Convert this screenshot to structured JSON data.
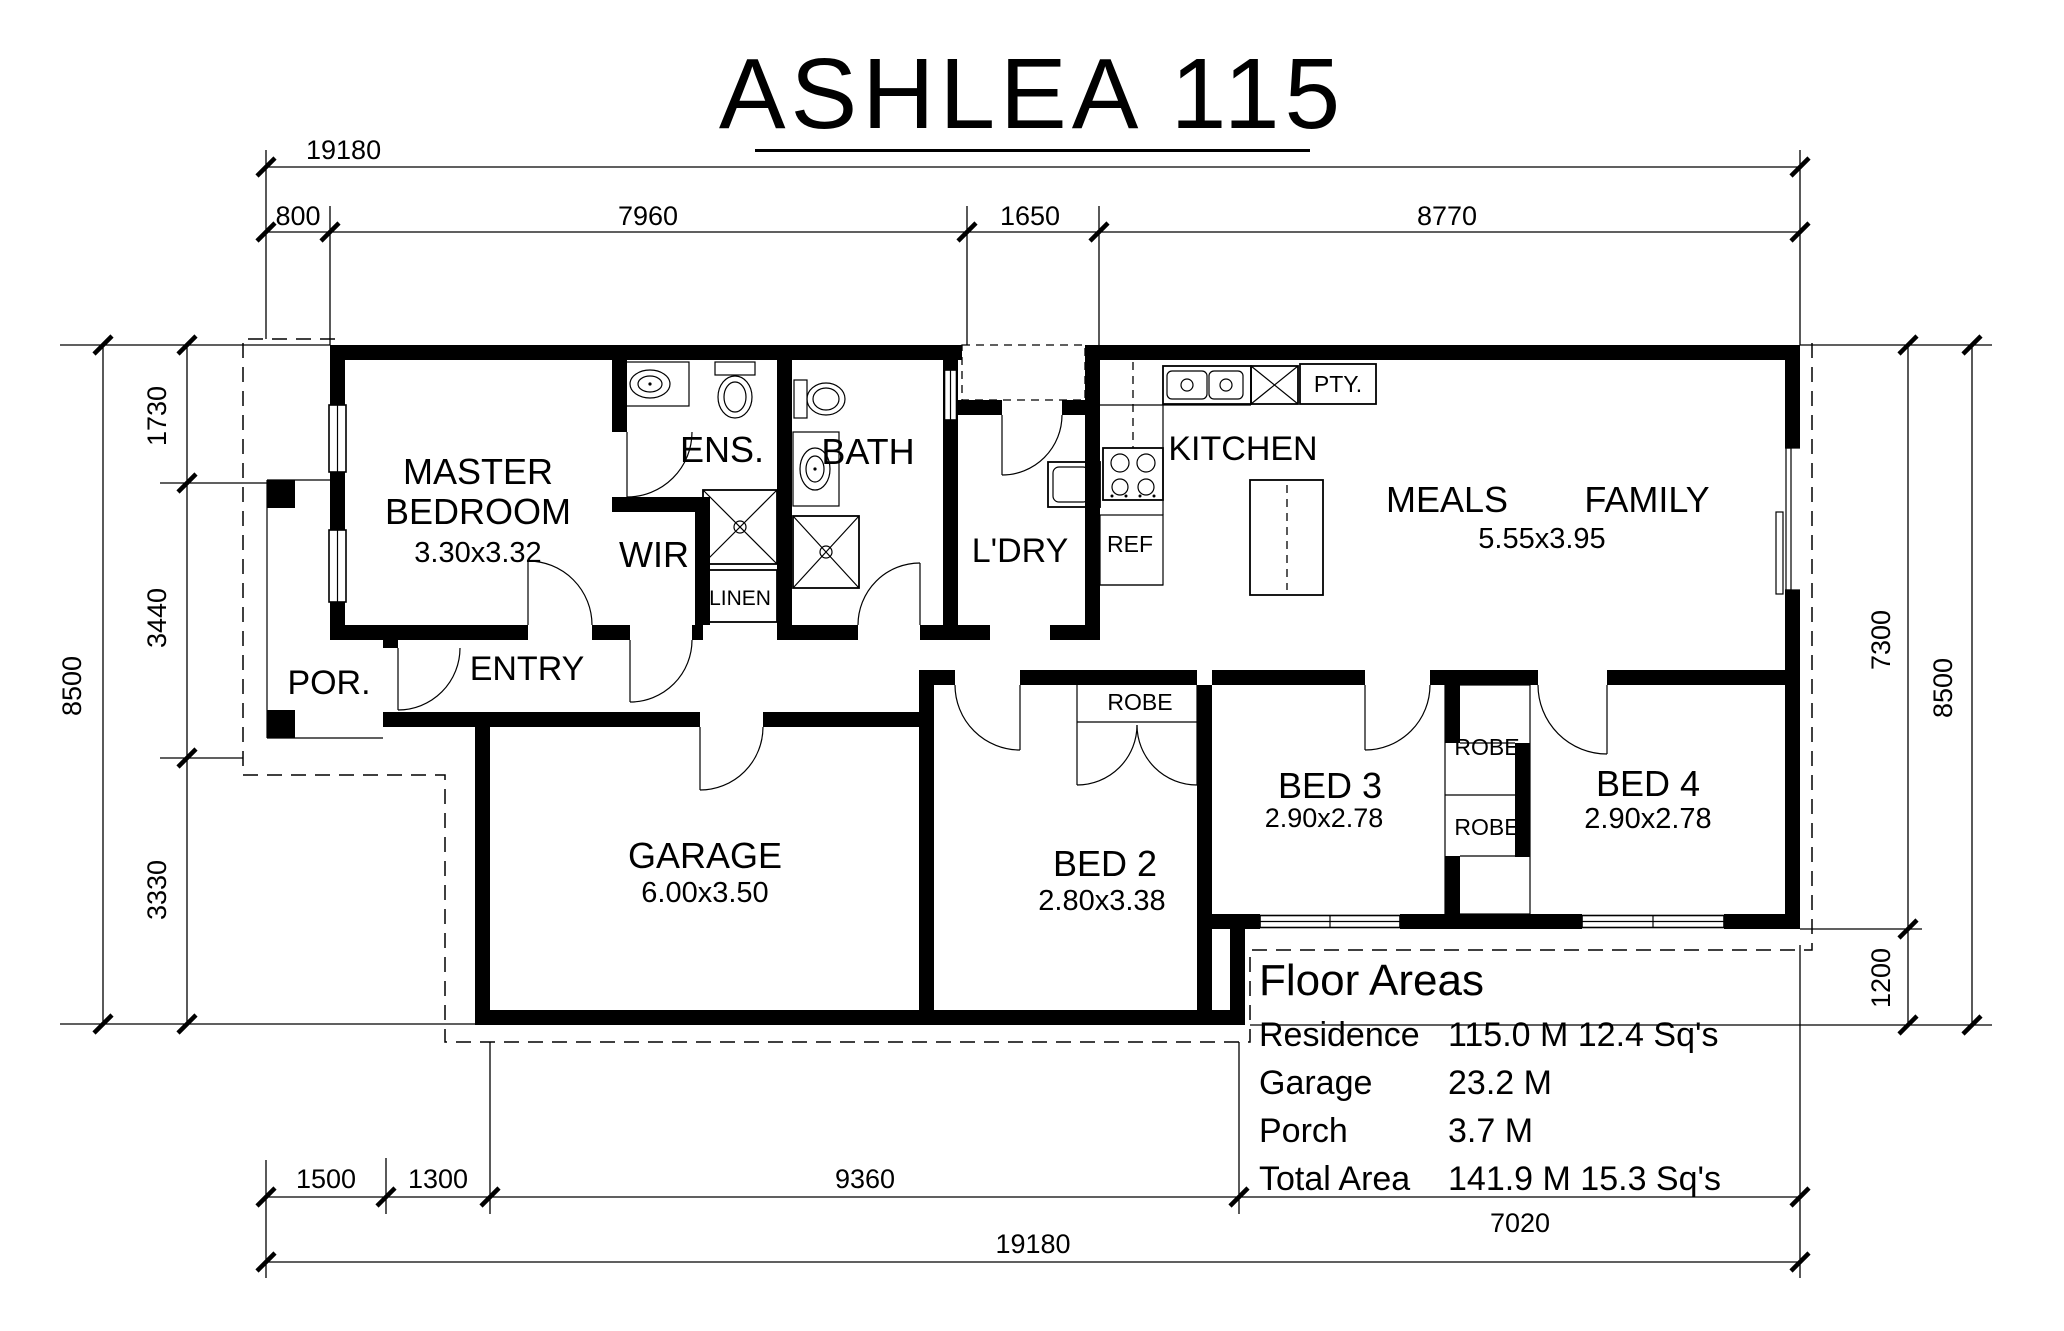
{
  "title": {
    "text": "ASHLEA 115"
  },
  "rooms": {
    "master": {
      "line1": "MASTER",
      "line2": "BEDROOM",
      "dims": "3.30x3.32"
    },
    "ens": "ENS.",
    "wir": "WIR",
    "linen": "LINEN",
    "bath": "BATH",
    "ldry": "L'DRY",
    "kitchen": "KITCHEN",
    "pantry": "PTY.",
    "fridge": "REF",
    "meals": "MEALS",
    "family": "FAMILY",
    "meals_family_dims": "5.55x3.95",
    "porch": "POR.",
    "entry": "ENTRY",
    "garage": {
      "name": "GARAGE",
      "dims": "6.00x3.50"
    },
    "bed2": {
      "name": "BED 2",
      "dims": "2.80x3.38"
    },
    "bed3": {
      "name": "BED 3",
      "dims": "2.90x2.78"
    },
    "bed4": {
      "name": "BED 4",
      "dims": "2.90x2.78"
    },
    "robe_bed2": "ROBE",
    "robe_top": "ROBE",
    "robe_bottom": "ROBE"
  },
  "dimensions": {
    "top": {
      "overall": "19180",
      "seg_800": "800",
      "seg_7960": "7960",
      "seg_1650": "1650",
      "seg_8770": "8770"
    },
    "bottom": {
      "overall": "19180",
      "seg_1500": "1500",
      "seg_1300": "1300",
      "seg_9360": "9360",
      "seg_7020": "7020"
    },
    "left": {
      "overall": "8500",
      "seg_1730": "1730",
      "seg_3440": "3440",
      "seg_3330": "3330"
    },
    "right": {
      "overall": "8500",
      "seg_7300": "7300",
      "seg_1200": "1200"
    }
  },
  "floor_areas": {
    "heading": "Floor Areas",
    "rows": [
      {
        "label": "Residence",
        "value": "115.0 M 12.4 Sq's"
      },
      {
        "label": "Garage",
        "value": "23.2 M"
      },
      {
        "label": "Porch",
        "value": "3.7 M"
      },
      {
        "label": "Total Area",
        "value": "141.9 M 15.3 Sq's"
      }
    ]
  },
  "colors": {
    "ink": "#000000",
    "paper": "#ffffff"
  }
}
